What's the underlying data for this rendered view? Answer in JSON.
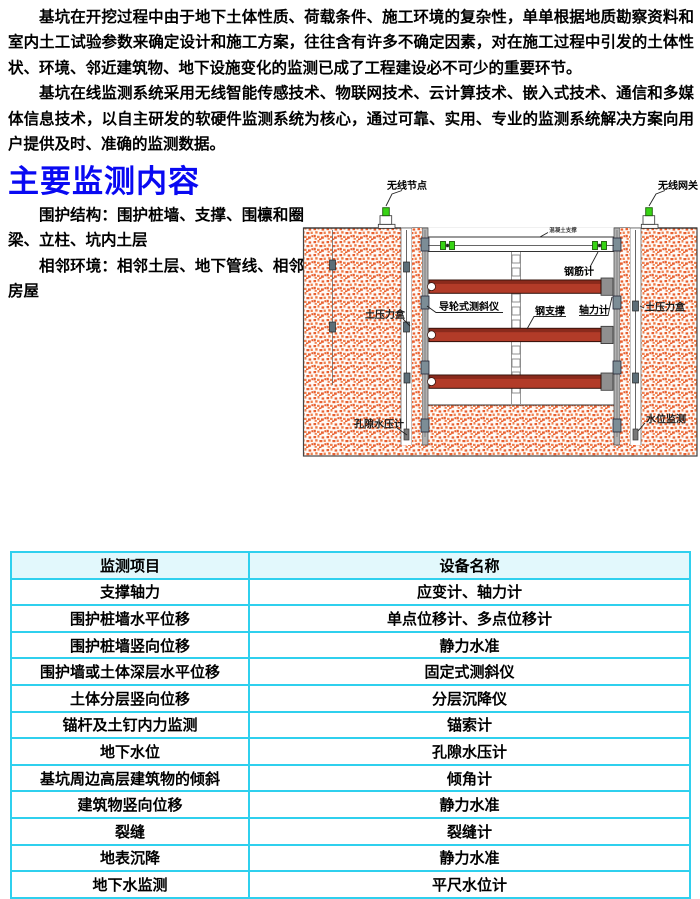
{
  "content": {
    "paragraphs": [
      "基坑在开挖过程中由于地下土体性质、荷载条件、施工环境的复杂性，单单根据地质勘察资料和室内土工试验参数来确定设计和施工方案，往往含有许多不确定因素，对在施工过程中引发的土体性状、环境、邻近建筑物、地下设施变化的监测已成了工程建设必不可少的重要环节。",
      "基坑在线监测系统采用无线智能传感技术、物联网技术、云计算技术、嵌入式技术、通信和多媒体信息技术，以自主研发的软硬件监测系统为核心，通过可靠、实用、专业的监测系统解决方案向用户提供及时、准确的监测数据。"
    ],
    "heading": "主要监测内容",
    "side_paragraphs": [
      "围护结构：围护桩墙、支撑、围檩和圈梁、立柱、坑内土层",
      "相邻环境：相邻土层、地下管线、相邻房屋"
    ]
  },
  "diagram": {
    "labels": {
      "wireless_node": "无线节点",
      "wireless_gateway": "无线网关",
      "concrete_support": "混凝土支撑",
      "rebar_meter": "钢筋计",
      "guide_wheel_inclinometer": "导轮式测斜仪",
      "steel_support": "钢支撑",
      "axial_force_meter": "轴力计",
      "earth_pressure_box_left": "土压力盒",
      "earth_pressure_box_right": "土压力盒",
      "pore_water_pressure_meter": "孔隙水压计",
      "water_level_monitoring": "水位监测"
    }
  },
  "table": {
    "headers": [
      "监测项目",
      "设备名称"
    ],
    "rows": [
      [
        "支撑轴力",
        "应变计、轴力计"
      ],
      [
        "围护桩墙水平位移",
        "单点位移计、多点位移计"
      ],
      [
        "围护桩墙竖向位移",
        "静力水准"
      ],
      [
        "围护墙或土体深层水平位移",
        "固定式测斜仪"
      ],
      [
        "土体分层竖向位移",
        "分层沉降仪"
      ],
      [
        "锚杆及土钉内力监测",
        "锚索计"
      ],
      [
        "地下水位",
        "孔隙水压计"
      ],
      [
        "基坑周边高层建筑物的倾斜",
        "倾角计"
      ],
      [
        "建筑物竖向位移",
        "静力水准"
      ],
      [
        "裂缝",
        "裂缝计"
      ],
      [
        "地表沉降",
        "静力水准"
      ],
      [
        "地下水监测",
        "平尺水位计"
      ]
    ]
  },
  "colors": {
    "heading_blue": "#0909f2",
    "table_border_cyan": "#2fd0ee",
    "table_header_bg": "#e2f8fc",
    "soil_orange": "#e86030",
    "steel_support_red": "#b23b28",
    "sensor_green": "#37d414",
    "wall_gray": "#b2b2b2"
  }
}
